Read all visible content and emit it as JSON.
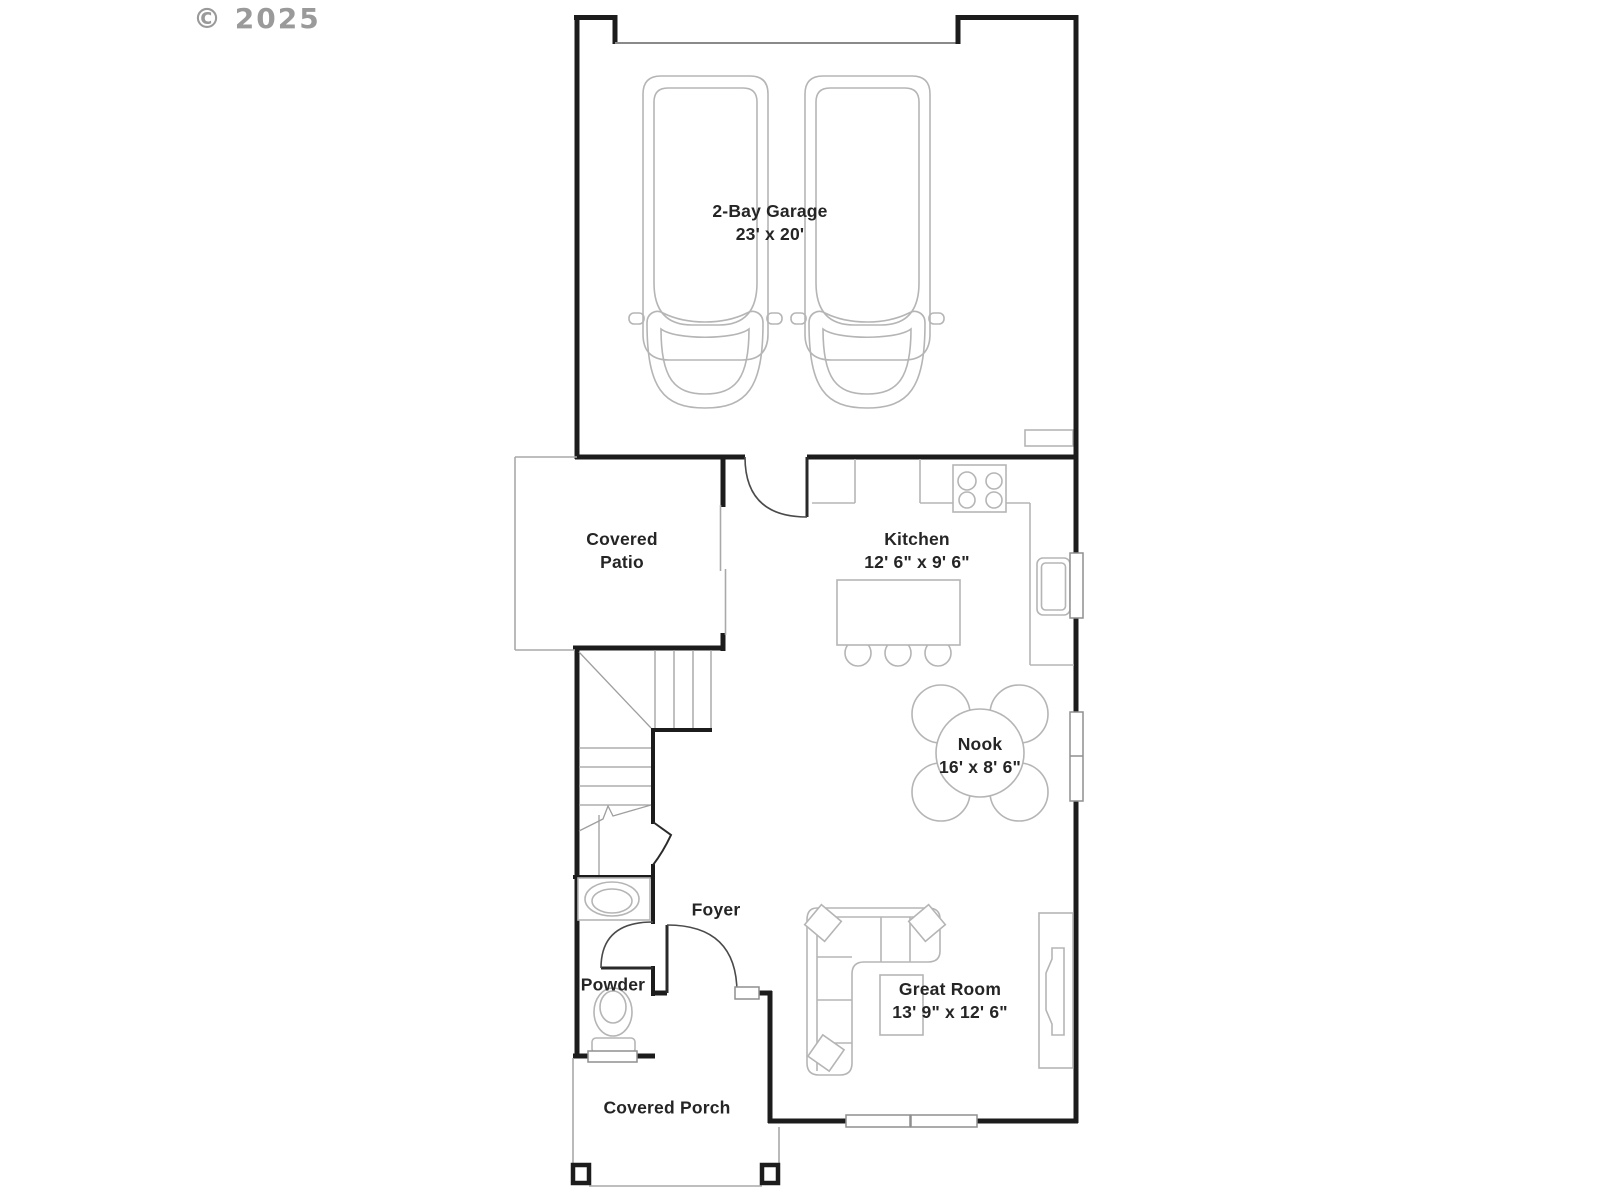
{
  "watermark": {
    "text": "© 2025"
  },
  "plan": {
    "title": "First floor plan",
    "rooms": [
      {
        "name": "2-Bay Garage",
        "dims": "23' x 20'"
      },
      {
        "name": "Covered Patio",
        "dims": ""
      },
      {
        "name": "Kitchen",
        "dims": "12' 6\" x 9' 6\""
      },
      {
        "name": "Nook",
        "dims": "16' x 8' 6\""
      },
      {
        "name": "Foyer",
        "dims": ""
      },
      {
        "name": "Powder",
        "dims": ""
      },
      {
        "name": "Great Room",
        "dims": "13' 9\" x 12' 6\""
      },
      {
        "name": "Covered Porch",
        "dims": ""
      }
    ],
    "fixtures": [
      "car",
      "car",
      "garage-door",
      "range-stove",
      "kitchen-island",
      "bar-stools",
      "kitchen-sink",
      "refrigerator-nook",
      "dining-table",
      "dining-chairs",
      "stairs",
      "sliding-glass-door",
      "entry-door",
      "powder-door",
      "vanity-sink",
      "toilet",
      "sectional-sofa",
      "throw-pillows",
      "coffee-table",
      "tv-console",
      "windows",
      "porch-posts",
      "shelf"
    ],
    "colors": {
      "wall": "#1c1c1c",
      "fixture": "#b5b5b5",
      "text": "#252525",
      "watermark": "#9a9a9a",
      "background": "#ffffff",
      "outline": "#a9a9a9"
    }
  }
}
